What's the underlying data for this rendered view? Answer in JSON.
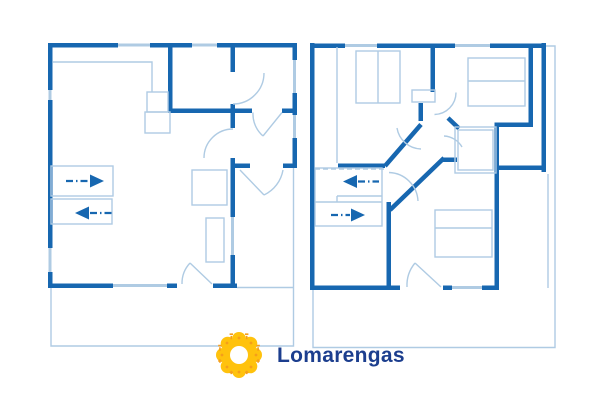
{
  "canvas": {
    "width": 600,
    "height": 400
  },
  "colors": {
    "background": "#FFFFFF",
    "wall": "#1767B0",
    "light": "#AFCBE3",
    "navy": "#1C3E8E",
    "yellow": "#FFC20D",
    "accent": "#F59E1B"
  },
  "brand": {
    "name": "Lomarengas",
    "logo_icon": "sun-flower-icon"
  }
}
